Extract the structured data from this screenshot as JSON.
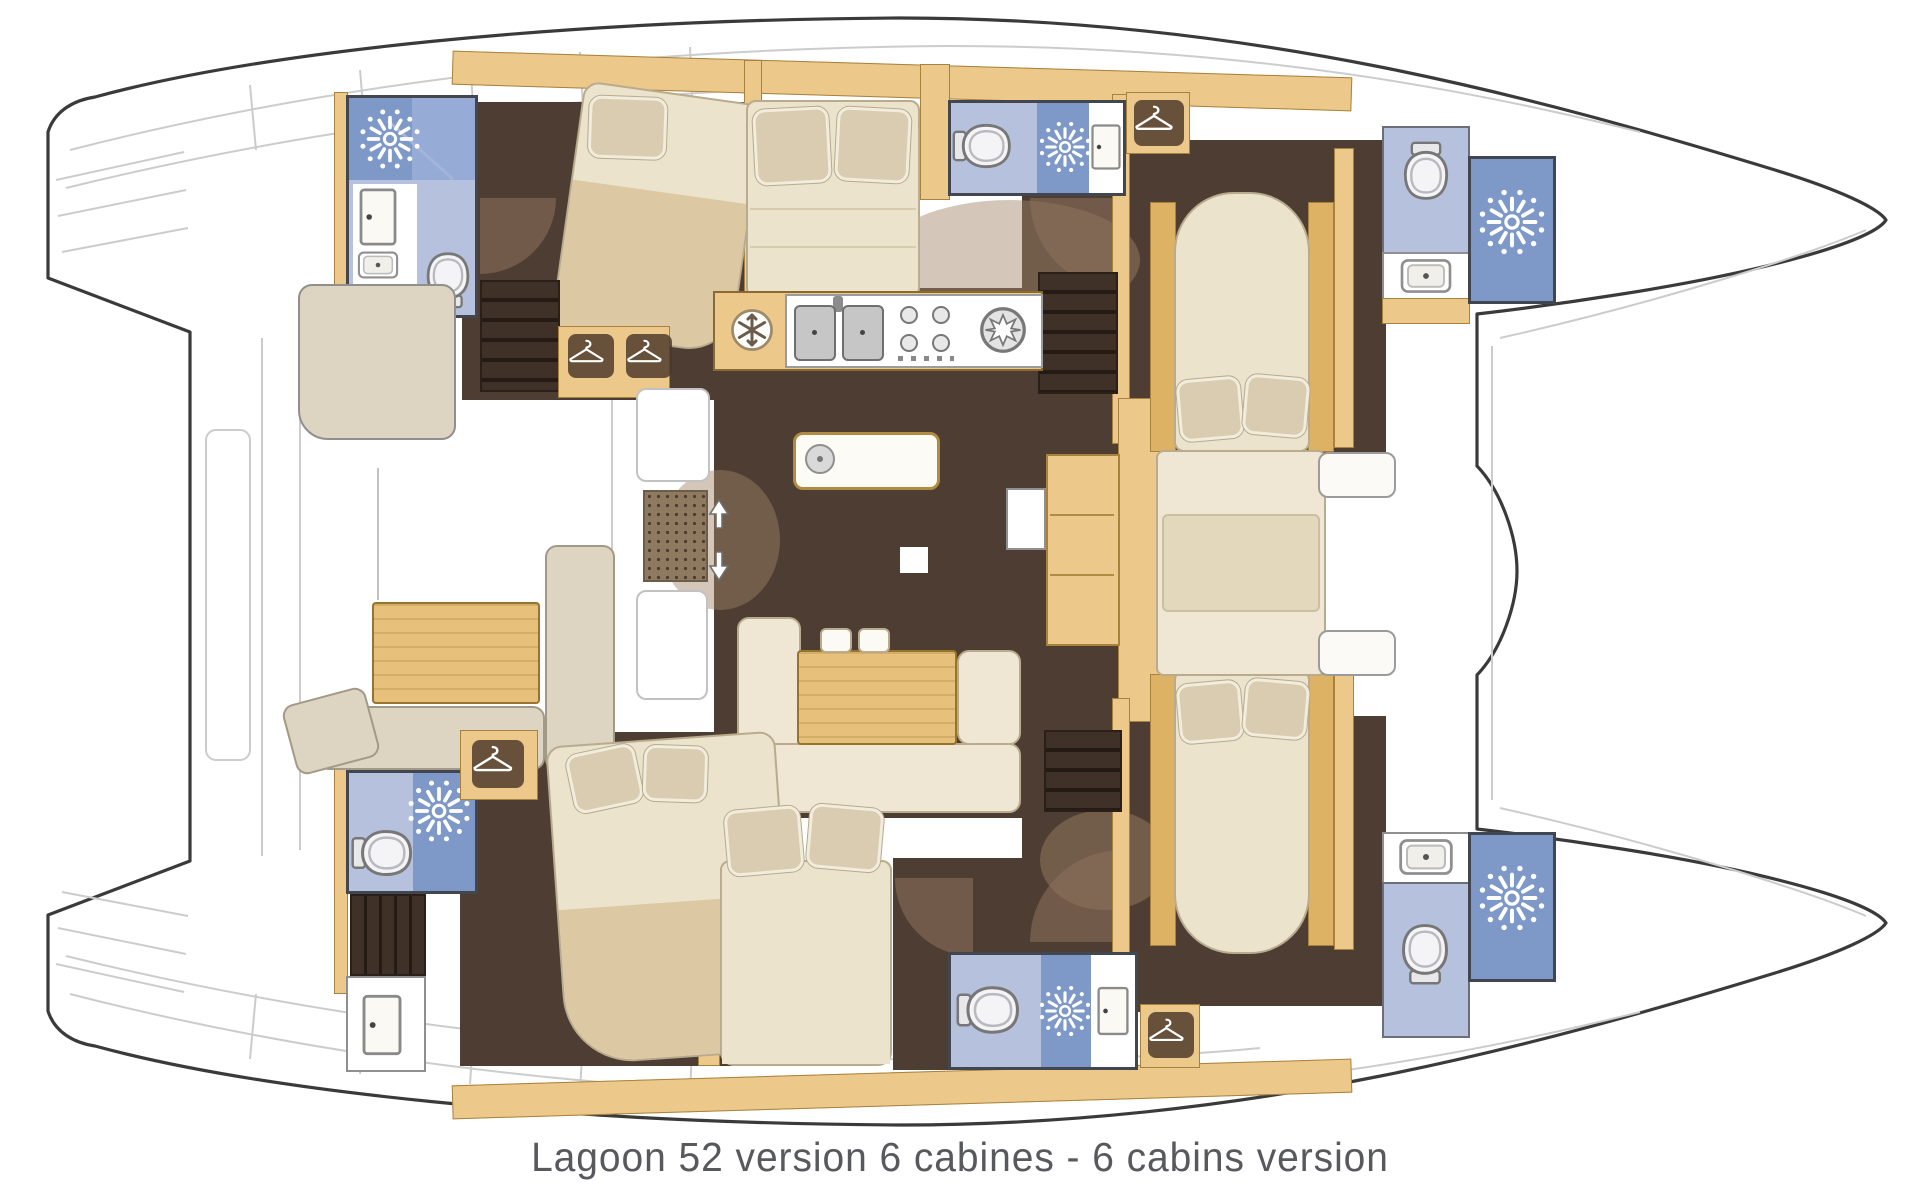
{
  "caption": "Lagoon 52 version 6 cabines - 6 cabins version",
  "palette": {
    "outline": "#3a3a3a",
    "deckline": "#cccccc",
    "tan": "#ecc98b",
    "tanborder": "#a8813d",
    "tandark": "#ddb264",
    "floor": "#4e3d33",
    "shower": "#7e99c8",
    "showerglass": "#a3b5db",
    "wc": "#b6c1dd",
    "cream": "#efe7d3",
    "creamborder": "#b9ab8d",
    "mattress": "#ece3cd",
    "blanket": "#dcc9a4",
    "pillowbeige": "#d9ccb0",
    "pillowedge": "#f2ecdd",
    "beige": "#ddd4c2",
    "beigeborder": "#a29a86",
    "tablewood": "#e7c17c",
    "tableborder": "#96742e",
    "counterwhite": "#ffffff",
    "grayborder": "#8f8f8f",
    "stairdark": "#3f3028",
    "stairline": "#241b15",
    "captioncolor": "#58595c",
    "matbrown": "#8d7a60",
    "arcbrown": "#8e7257"
  },
  "icons": {
    "shower-head-icon": "white starburst of rays and dots",
    "wardrobe-icon": "white clothes hanger on dark plate",
    "toilet-icon": "toilet seen from above",
    "fridge-icon": "snowflake in white circle",
    "burner-icon": "star in gray ring",
    "companionway-icon": "white up-down arrows",
    "sink-icon": "white basin with drain dot",
    "door-icon": "white panel with handle dot"
  }
}
